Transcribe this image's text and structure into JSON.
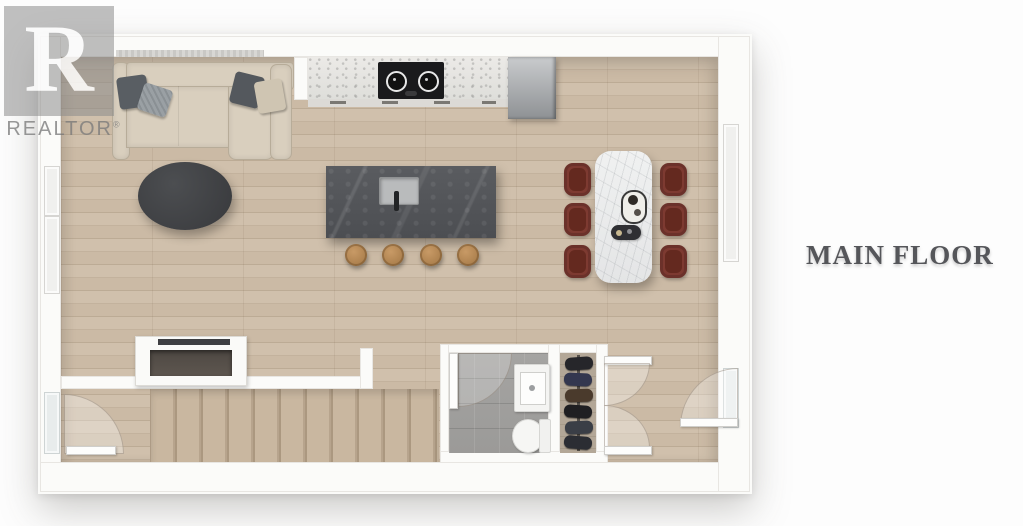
{
  "title": {
    "label": "MAIN FLOOR",
    "color": "#55565a"
  },
  "watermark": {
    "letter": "R",
    "brand": "REALTOR",
    "mark": "®",
    "color": "#8a8a8a"
  },
  "palette": {
    "wall": "#fbfbf9",
    "wood_floor": "#cbbaa5",
    "stair_wood": "#c0ae97",
    "bath_tile": "#a09f9d",
    "island_stone": "#53555a",
    "counter_marble": "#e5e4e1",
    "dining_table_marble": "#eceded",
    "dining_chair": "#7d3a31",
    "sofa": "#d9cfbe",
    "coffee_table": "#3f4144",
    "stool_wood": "#b2834f",
    "fridge_steel": "#a9abae",
    "cooktop": "#1a1a1c"
  }
}
